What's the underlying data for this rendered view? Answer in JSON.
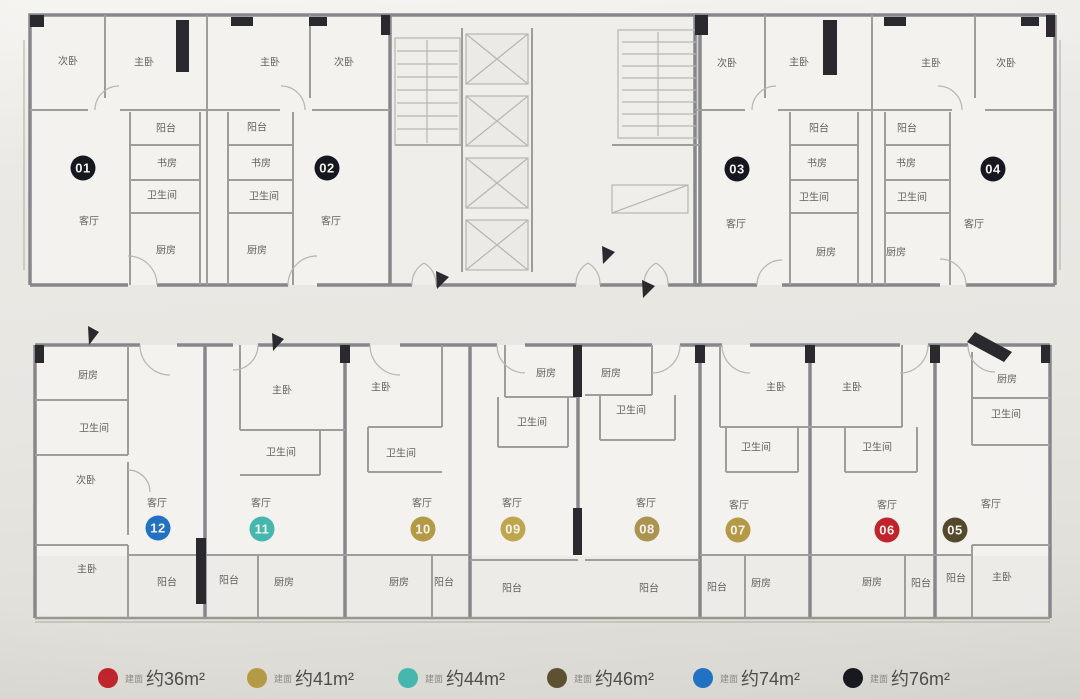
{
  "plan": {
    "unit_badges": [
      {
        "num": "01",
        "x": 83,
        "y": 168,
        "color": "#17171f"
      },
      {
        "num": "02",
        "x": 327,
        "y": 168,
        "color": "#17171f"
      },
      {
        "num": "03",
        "x": 737,
        "y": 169,
        "color": "#17171f"
      },
      {
        "num": "04",
        "x": 993,
        "y": 169,
        "color": "#17171f"
      },
      {
        "num": "05",
        "x": 955,
        "y": 530,
        "color": "#55492b"
      },
      {
        "num": "06",
        "x": 887,
        "y": 530,
        "color": "#c0232b"
      },
      {
        "num": "07",
        "x": 738,
        "y": 530,
        "color": "#b59a46"
      },
      {
        "num": "08",
        "x": 647,
        "y": 529,
        "color": "#ab9450"
      },
      {
        "num": "09",
        "x": 513,
        "y": 529,
        "color": "#bfa64e"
      },
      {
        "num": "10",
        "x": 423,
        "y": 529,
        "color": "#b59a46"
      },
      {
        "num": "11",
        "x": 262,
        "y": 529,
        "color": "#45b7ae"
      },
      {
        "num": "12",
        "x": 158,
        "y": 528,
        "color": "#2172c2"
      }
    ],
    "room_labels": [
      {
        "t": "次卧",
        "x": 68,
        "y": 60
      },
      {
        "t": "主卧",
        "x": 144,
        "y": 61
      },
      {
        "t": "阳台",
        "x": 166,
        "y": 127
      },
      {
        "t": "书房",
        "x": 167,
        "y": 162
      },
      {
        "t": "卫生间",
        "x": 162,
        "y": 194
      },
      {
        "t": "客厅",
        "x": 89,
        "y": 220
      },
      {
        "t": "厨房",
        "x": 166,
        "y": 249
      },
      {
        "t": "主卧",
        "x": 270,
        "y": 61
      },
      {
        "t": "次卧",
        "x": 344,
        "y": 61
      },
      {
        "t": "阳台",
        "x": 257,
        "y": 126
      },
      {
        "t": "书房",
        "x": 261,
        "y": 162
      },
      {
        "t": "卫生间",
        "x": 264,
        "y": 195
      },
      {
        "t": "客厅",
        "x": 331,
        "y": 220
      },
      {
        "t": "厨房",
        "x": 257,
        "y": 249
      },
      {
        "t": "次卧",
        "x": 727,
        "y": 62
      },
      {
        "t": "主卧",
        "x": 799,
        "y": 61
      },
      {
        "t": "阳台",
        "x": 819,
        "y": 127
      },
      {
        "t": "书房",
        "x": 817,
        "y": 162
      },
      {
        "t": "卫生间",
        "x": 814,
        "y": 196
      },
      {
        "t": "客厅",
        "x": 736,
        "y": 223
      },
      {
        "t": "厨房",
        "x": 826,
        "y": 251
      },
      {
        "t": "主卧",
        "x": 931,
        "y": 62
      },
      {
        "t": "次卧",
        "x": 1006,
        "y": 62
      },
      {
        "t": "阳台",
        "x": 907,
        "y": 127
      },
      {
        "t": "书房",
        "x": 906,
        "y": 162
      },
      {
        "t": "卫生间",
        "x": 912,
        "y": 196
      },
      {
        "t": "客厅",
        "x": 974,
        "y": 223
      },
      {
        "t": "厨房",
        "x": 896,
        "y": 251
      },
      {
        "t": "厨房",
        "x": 88,
        "y": 374
      },
      {
        "t": "卫生间",
        "x": 94,
        "y": 427
      },
      {
        "t": "次卧",
        "x": 86,
        "y": 479
      },
      {
        "t": "主卧",
        "x": 87,
        "y": 568
      },
      {
        "t": "客厅",
        "x": 157,
        "y": 502
      },
      {
        "t": "阳台",
        "x": 167,
        "y": 581
      },
      {
        "t": "主卧",
        "x": 282,
        "y": 389
      },
      {
        "t": "卫生间",
        "x": 281,
        "y": 451
      },
      {
        "t": "客厅",
        "x": 261,
        "y": 502
      },
      {
        "t": "阳台",
        "x": 229,
        "y": 579
      },
      {
        "t": "厨房",
        "x": 284,
        "y": 581
      },
      {
        "t": "主卧",
        "x": 381,
        "y": 386
      },
      {
        "t": "卫生间",
        "x": 401,
        "y": 452
      },
      {
        "t": "客厅",
        "x": 422,
        "y": 502
      },
      {
        "t": "厨房",
        "x": 399,
        "y": 581
      },
      {
        "t": "阳台",
        "x": 444,
        "y": 581
      },
      {
        "t": "厨房",
        "x": 546,
        "y": 372
      },
      {
        "t": "卫生间",
        "x": 532,
        "y": 421
      },
      {
        "t": "客厅",
        "x": 512,
        "y": 502
      },
      {
        "t": "阳台",
        "x": 512,
        "y": 587
      },
      {
        "t": "厨房",
        "x": 611,
        "y": 372
      },
      {
        "t": "卫生间",
        "x": 631,
        "y": 409
      },
      {
        "t": "客厅",
        "x": 646,
        "y": 502
      },
      {
        "t": "阳台",
        "x": 649,
        "y": 587
      },
      {
        "t": "主卧",
        "x": 776,
        "y": 386
      },
      {
        "t": "卫生间",
        "x": 756,
        "y": 446
      },
      {
        "t": "客厅",
        "x": 739,
        "y": 504
      },
      {
        "t": "阳台",
        "x": 717,
        "y": 586
      },
      {
        "t": "厨房",
        "x": 761,
        "y": 582
      },
      {
        "t": "主卧",
        "x": 852,
        "y": 386
      },
      {
        "t": "卫生间",
        "x": 877,
        "y": 446
      },
      {
        "t": "客厅",
        "x": 887,
        "y": 504
      },
      {
        "t": "厨房",
        "x": 872,
        "y": 581
      },
      {
        "t": "阳台",
        "x": 921,
        "y": 582
      },
      {
        "t": "厨房",
        "x": 1007,
        "y": 378
      },
      {
        "t": "卫生间",
        "x": 1006,
        "y": 413
      },
      {
        "t": "客厅",
        "x": 991,
        "y": 503
      },
      {
        "t": "阳台",
        "x": 956,
        "y": 577
      },
      {
        "t": "主卧",
        "x": 1002,
        "y": 576
      }
    ]
  },
  "legend": {
    "items": [
      {
        "color": "#c0232b",
        "prefix": "建面",
        "label": "约36m²",
        "x": 98
      },
      {
        "color": "#b59a46",
        "prefix": "建面",
        "label": "约41m²",
        "x": 247
      },
      {
        "color": "#45b7ae",
        "prefix": "建面",
        "label": "约44m²",
        "x": 398
      },
      {
        "color": "#5c5231",
        "prefix": "建面",
        "label": "约46m²",
        "x": 547
      },
      {
        "color": "#2172c2",
        "prefix": "建面",
        "label": "约74m²",
        "x": 693
      },
      {
        "color": "#17171f",
        "prefix": "建面",
        "label": "约76m²",
        "x": 843
      }
    ]
  }
}
